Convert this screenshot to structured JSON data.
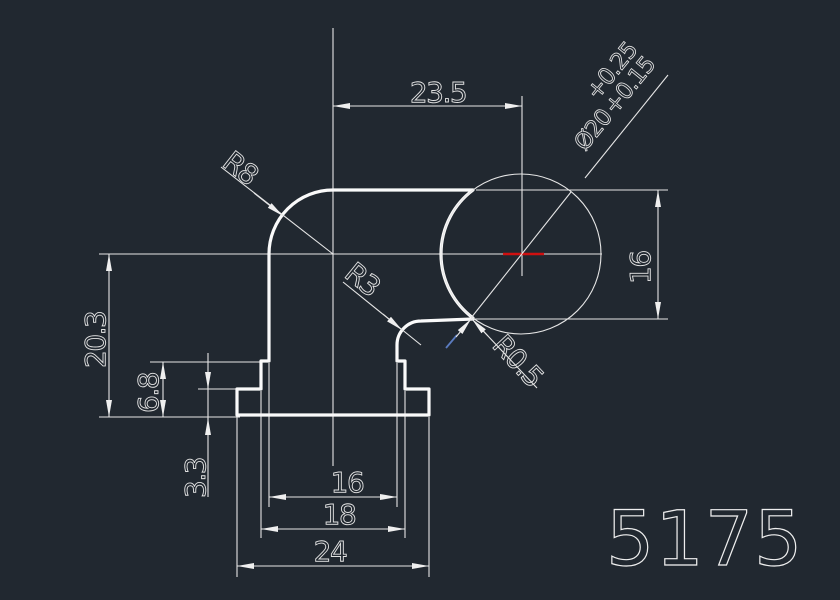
{
  "canvas": {
    "background": "#212830",
    "line_color": "#efefef",
    "center_mark_color": "#cf1010",
    "snap_hint_color": "#5b7cc0"
  },
  "drawing": {
    "part_number": "5175",
    "dimensions": {
      "top_offset": "23.5",
      "bore_height": "16",
      "overall_height": "20.3",
      "step_height": "6.8",
      "flange_height": "3.3",
      "stem_width": "16",
      "step_width": "18",
      "flange_width": "24"
    },
    "radii": {
      "corner": "R8",
      "fillet": "R3",
      "edge_fillet": "R0.5"
    },
    "bore": {
      "diameter": "Ø20",
      "upper_tolerance": "+0.25",
      "lower_tolerance": "+0.15"
    }
  }
}
